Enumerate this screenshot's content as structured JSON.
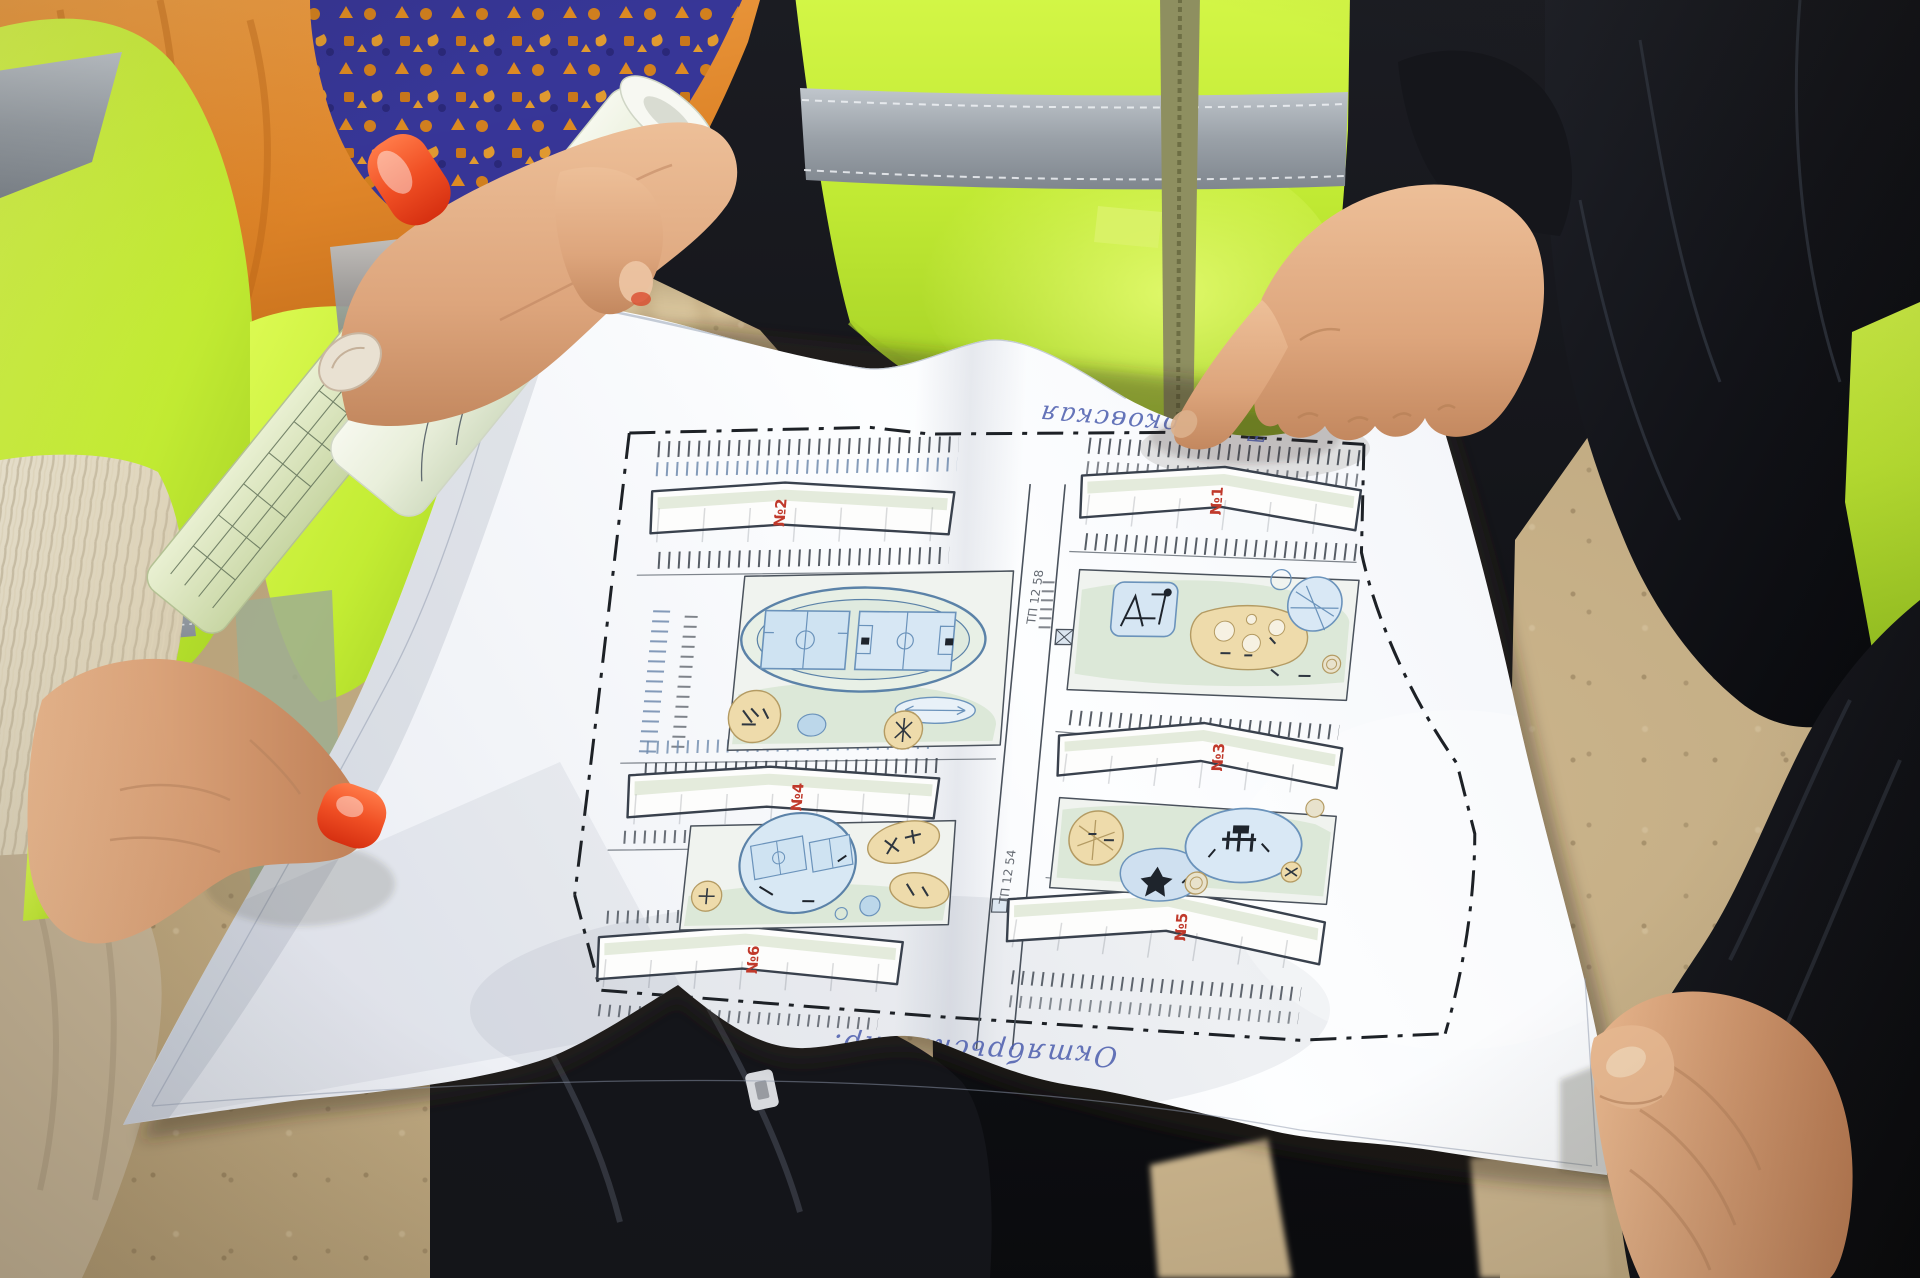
{
  "plan": {
    "handwritten_street_top": "Тентюковская",
    "handwritten_street_bottom": "Октябрьский пр.",
    "building_labels": [
      "№1",
      "№2",
      "№3",
      "№4",
      "№5",
      "№6"
    ],
    "substation_label_top": "ТП 12 58",
    "substation_label_bottom": "ТП 12 54"
  },
  "colors": {
    "hi_vis_green": "#cdf23e",
    "reflective_stripe": "#9ba2a9",
    "nail_polish": "#f04f24",
    "paper_white": "#f7f9fc",
    "plan_line": "#39414d",
    "plan_blue": "#5b82a8",
    "plan_tan": "#ecd9ab",
    "plan_green": "#dfe8d9",
    "plan_red_label": "#c0392b",
    "ink_blue": "#4a5cad"
  }
}
